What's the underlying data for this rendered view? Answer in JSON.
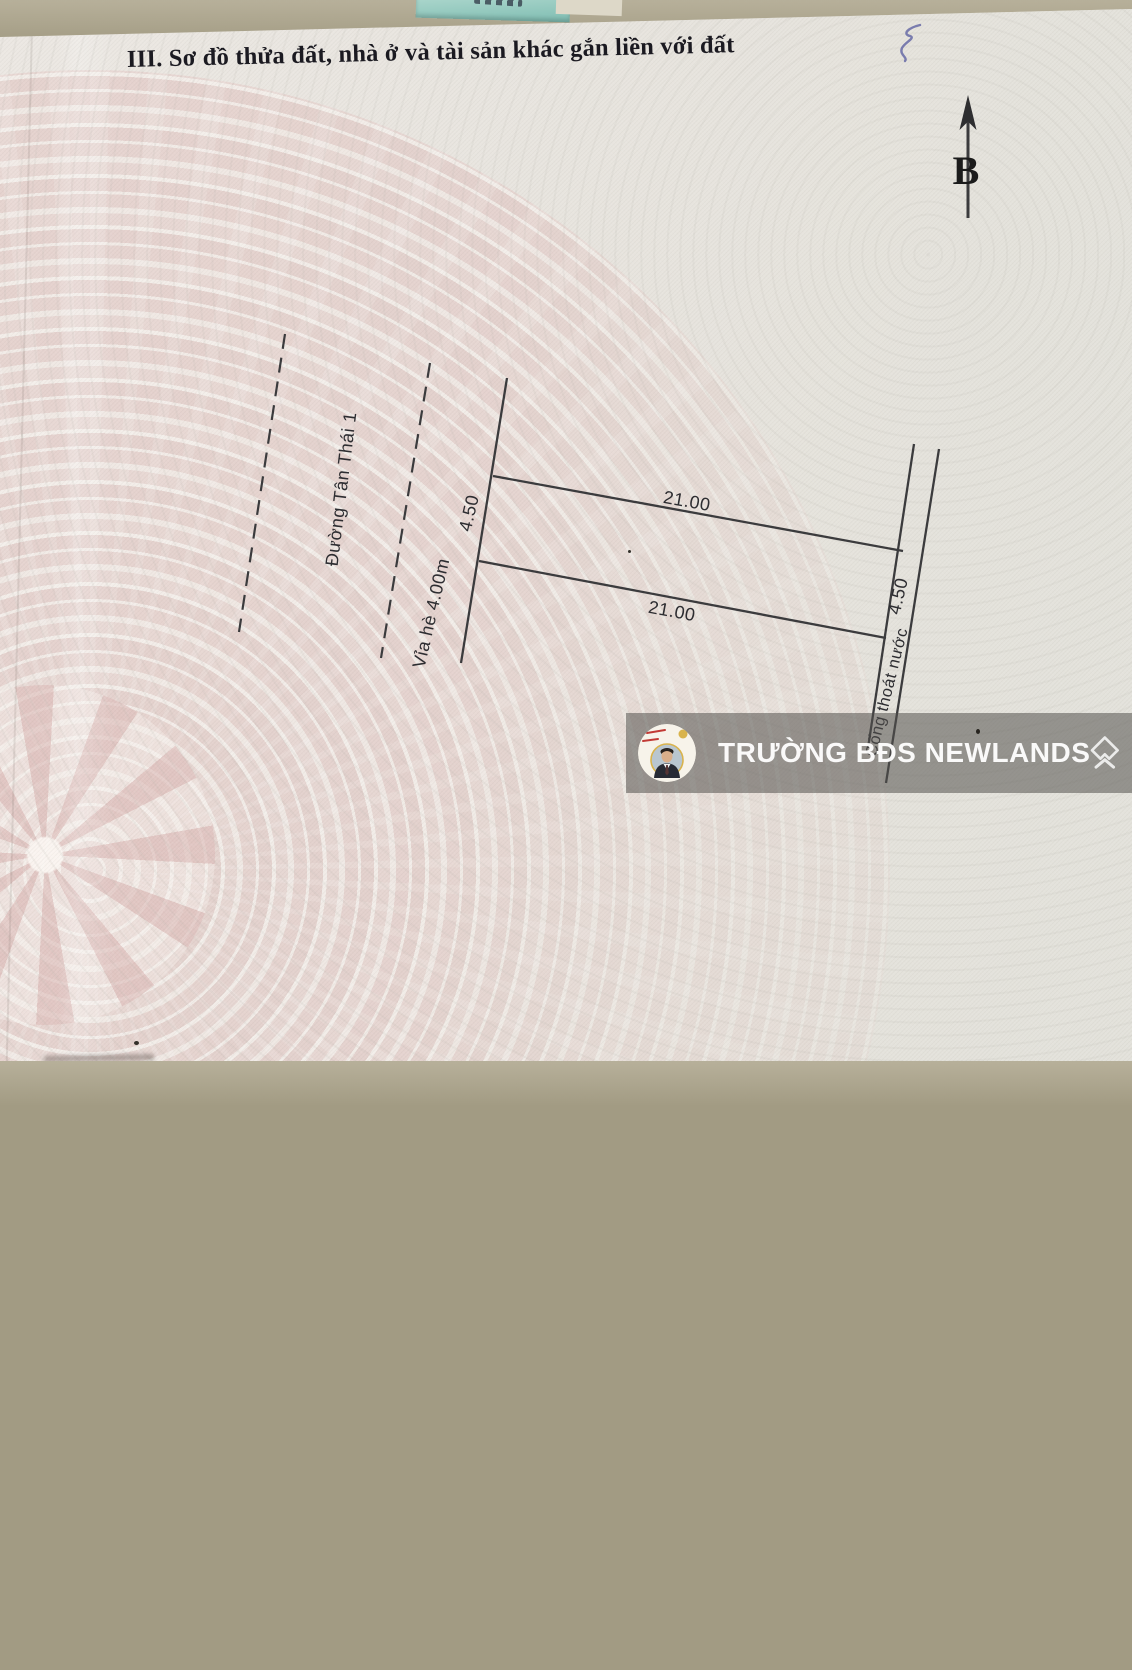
{
  "document": {
    "section_title": "III. Sơ đồ thửa đất, nhà ở và tài sản khác gắn liền với đất",
    "compass_label": "B"
  },
  "diagram": {
    "road_name": "Đường Tân Thái 1",
    "sidewalk": "Vỉa hè 4.00m",
    "drain": "Cống thoát nước",
    "front_width": "4.50",
    "back_width": "4.50",
    "top_length": "21.00",
    "bottom_length": "21.00"
  },
  "watermark": {
    "label": "TRƯỜNG BĐS NEWLANDS"
  },
  "colors": {
    "paper": "#e8e5df",
    "drum_pink": "#e2c4c1",
    "line": "#3b3b3d",
    "watermark_band": "rgba(84,82,78,0.55)",
    "watermark_text": "#ffffff",
    "table_background": "#a29b83",
    "note_paper": "#8ec7bd",
    "handwriting_ink": "#666aa6"
  }
}
